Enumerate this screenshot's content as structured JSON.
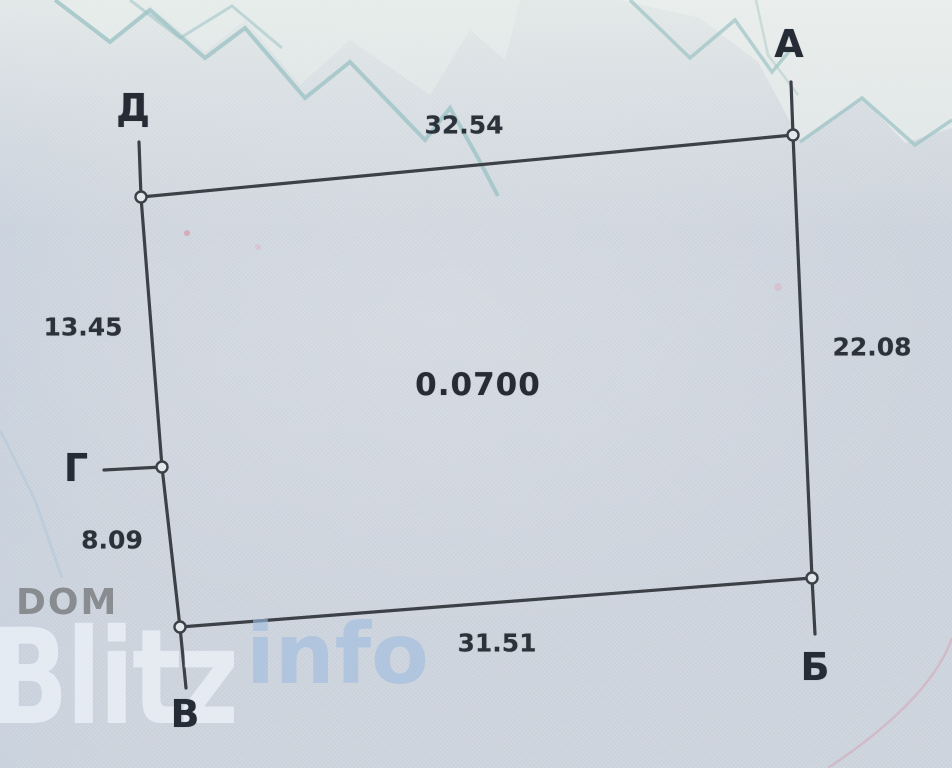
{
  "plot": {
    "area": "0.0700",
    "vertices": [
      {
        "id": "A",
        "label": "А"
      },
      {
        "id": "B",
        "label": "Б"
      },
      {
        "id": "V",
        "label": "В"
      },
      {
        "id": "G",
        "label": "Г"
      },
      {
        "id": "D",
        "label": "Д"
      }
    ],
    "sides": [
      {
        "name": "top",
        "from": "Д",
        "to": "А",
        "length": "32.54"
      },
      {
        "name": "right",
        "from": "А",
        "to": "Б",
        "length": "22.08"
      },
      {
        "name": "bottom",
        "from": "В",
        "to": "Б",
        "length": "31.51"
      },
      {
        "name": "left-upper",
        "from": "Д",
        "to": "Г",
        "length": "13.45"
      },
      {
        "name": "left-lower",
        "from": "Г",
        "to": "В",
        "length": "8.09"
      }
    ]
  },
  "watermark": {
    "dom": "DOM",
    "blitz": "Blitz",
    "info": "info"
  },
  "colors": {
    "background": "#ccd3dc",
    "line": "#3c4148",
    "label": "#262c35",
    "zigzag": "#9dc3c5"
  }
}
